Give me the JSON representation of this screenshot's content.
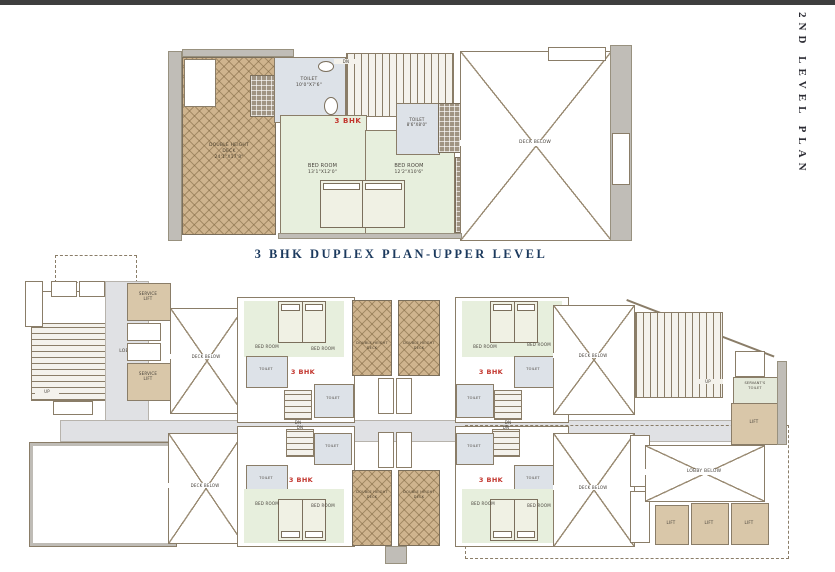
{
  "side_title": "2ND LEVEL PLAN",
  "plan_title": "3 BHK DUPLEX PLAN-UPPER LEVEL",
  "colors": {
    "accent_red": "#c2342c",
    "title_blue": "#1c3a5e",
    "deck_tan": "#cfb48e",
    "bedroom_green": "#e7efdd",
    "toilet_gray": "#dde2e8",
    "wall_gray": "#c0bdb7",
    "line_brown": "#8a7d68"
  },
  "labels": {
    "unit": "3 BHK",
    "bed_room": "BED ROOM",
    "toilet": "TOILET",
    "deck_below": "DECK BELOW",
    "double_height": "DOUBLE HEIGHT",
    "deck": "DECK",
    "dn": "DN",
    "up": "UP",
    "lobby": "LOBBY",
    "service": "SERVICE",
    "lift": "LIFT",
    "servants": "SERVANT'S",
    "lobby_below": "LOBBY BELOW"
  },
  "upper_plan": {
    "deck_dim": "24'1\"X17'8\"",
    "toilet1_dim": "10'0\"X7'6\"",
    "toilet2_dim": "8'6\"X8'0\"",
    "bedroom1_dim": "13'1\"X12'0\"",
    "bedroom2_dim": "12'2\"X10'6\""
  }
}
